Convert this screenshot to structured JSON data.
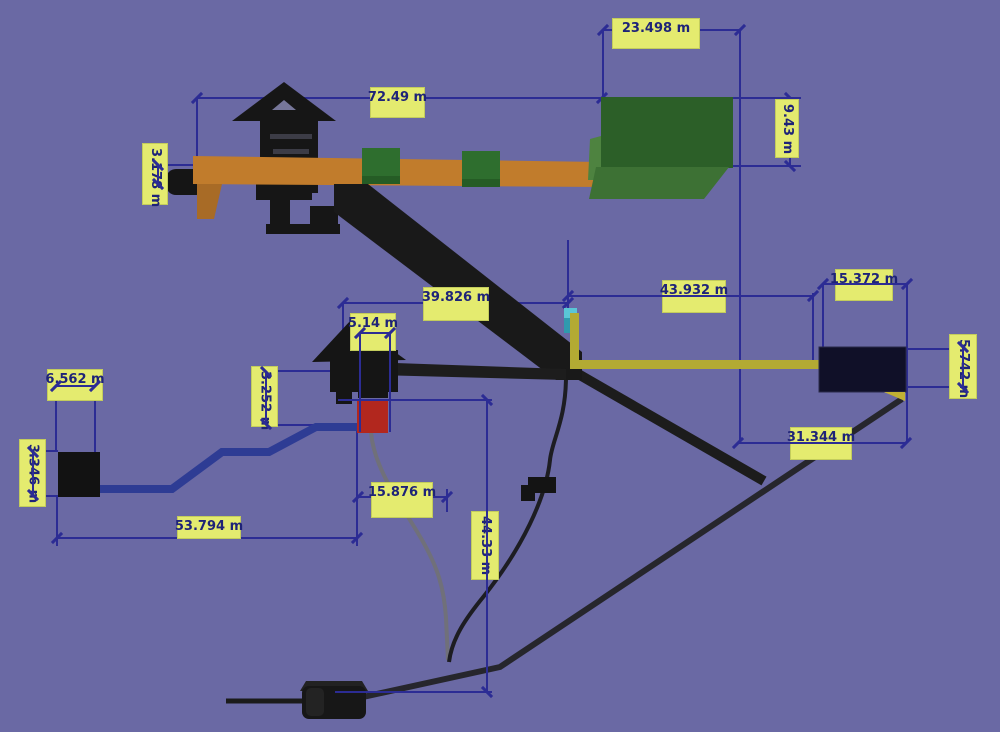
{
  "viewport": {
    "type": "3d-measurement-view",
    "unit": "m",
    "colors": {
      "background": "#6a69a4",
      "dimension_line": "#2c2c94",
      "label_background": "#e4eb6f",
      "label_text": "#1e2378",
      "structure_black": "#171717",
      "conveyor_orange": "#c17c2c",
      "box_green_dark": "#2c5f28",
      "box_green_light": "#3d7134",
      "box_red": "#b2271e",
      "chute_cyan": "#4fc0d2",
      "conveyor_yellow": "#b3aa33",
      "bin_navy": "#101028",
      "pipeline_blue": "#2e3c94",
      "cable_gray": "#70707a"
    }
  },
  "measurements": [
    {
      "label": "23.498 m",
      "orientation": "horizontal"
    },
    {
      "label": "72.49 m",
      "orientation": "horizontal"
    },
    {
      "label": "9.43 m",
      "orientation": "vertical"
    },
    {
      "label": "3.178 m",
      "orientation": "vertical"
    },
    {
      "label": "39.826 m",
      "orientation": "horizontal"
    },
    {
      "label": "43.932 m",
      "orientation": "horizontal"
    },
    {
      "label": "15.372 m",
      "orientation": "horizontal"
    },
    {
      "label": "5.742 m",
      "orientation": "vertical"
    },
    {
      "label": "5.14 m",
      "orientation": "horizontal"
    },
    {
      "label": "3.252 m",
      "orientation": "vertical"
    },
    {
      "label": "6.562 m",
      "orientation": "horizontal"
    },
    {
      "label": "3.346 m",
      "orientation": "vertical"
    },
    {
      "label": "53.794 m",
      "orientation": "horizontal"
    },
    {
      "label": "15.876 m",
      "orientation": "horizontal"
    },
    {
      "label": "44.33 m",
      "orientation": "vertical"
    },
    {
      "label": "31.344 m",
      "orientation": "horizontal"
    }
  ]
}
